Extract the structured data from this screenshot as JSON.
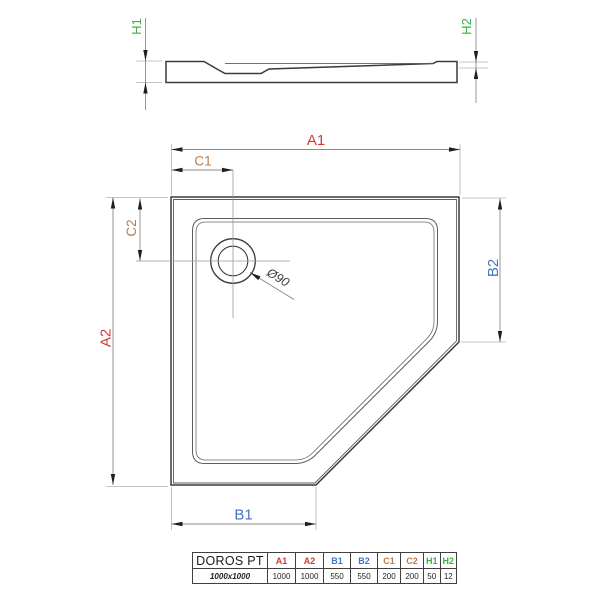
{
  "colors": {
    "red": "#d23b35",
    "blue": "#4373c4",
    "orange": "#bc7b4b",
    "green": "#3fae49",
    "line-dark": "#3a3a3a",
    "line-dim": "#8a8a8a",
    "line-ext": "#b2b2b2"
  },
  "side_view": {
    "h1": "H1",
    "h2": "H2"
  },
  "plan_view": {
    "a1": "A1",
    "a2": "A2",
    "b1": "B1",
    "b2": "B2",
    "c1": "C1",
    "c2": "C2",
    "drain_diameter": "Ø90"
  },
  "spec_table": {
    "model": "DOROS PT",
    "size": "1000x1000",
    "columns": [
      {
        "label": "A1",
        "value": "1000"
      },
      {
        "label": "A2",
        "value": "1000"
      },
      {
        "label": "B1",
        "value": "550"
      },
      {
        "label": "B2",
        "value": "550"
      },
      {
        "label": "C1",
        "value": "200"
      },
      {
        "label": "C2",
        "value": "200"
      },
      {
        "label": "H1",
        "value": "50"
      },
      {
        "label": "H2",
        "value": "12"
      }
    ]
  }
}
